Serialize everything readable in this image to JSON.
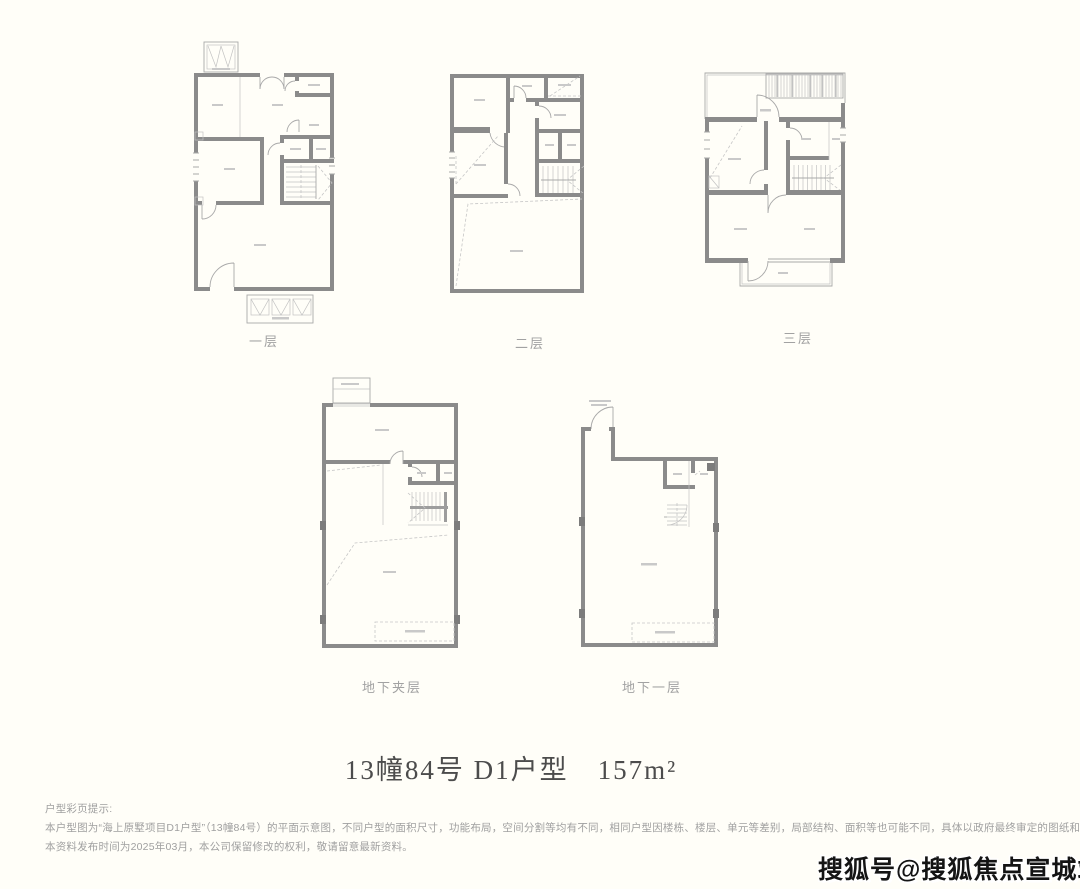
{
  "page": {
    "background": "#fffef8",
    "colors": {
      "wall": "#8b8b8b",
      "thin_line": "#a9a9a9",
      "caption_gray": "#a2a2a2",
      "title_gray": "#4c4c4c",
      "disclaimer_gray": "#a0a0a0",
      "watermark_black": "#141414"
    }
  },
  "plans": [
    {
      "id": "floor-1",
      "label": "一层"
    },
    {
      "id": "floor-2",
      "label": "二层"
    },
    {
      "id": "floor-3",
      "label": "三层"
    },
    {
      "id": "basement-mezzanine",
      "label": "地下夹层"
    },
    {
      "id": "basement-1",
      "label": "地下一层"
    }
  ],
  "title": {
    "text": "13幢84号 D1户型　157m²"
  },
  "disclaimer": {
    "heading": "户型彩页提示:",
    "body": "本户型图为“海上原墅项目D1户型”（13幢84号）的平面示意图，不同户型的面积尺寸，功能布局，空间分割等均有不同，相同户型因楼栋、楼层、单元等差别，局部结构、面积等也可能不同，具体以政府最终审定的图纸和《商品房买卖合同》为准。",
    "footer": "本资料发布时间为2025年03月，本公司保留修改的权利，敬请留意最新资料。"
  },
  "watermark": {
    "text": "搜狐号@搜狐焦点宣城站"
  }
}
